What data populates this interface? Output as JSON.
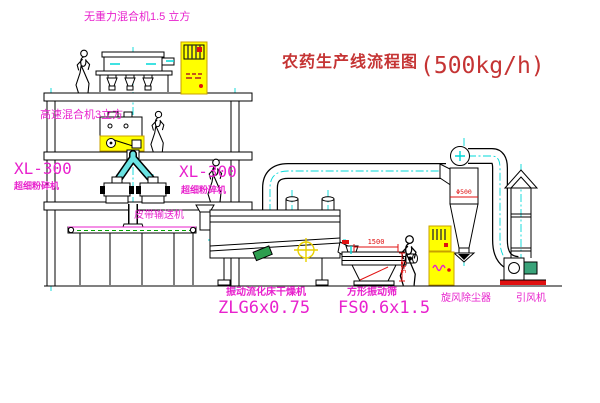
{
  "title": {
    "zh": "农药生产线流程图",
    "capacity": "(500kg/h)"
  },
  "labels": {
    "gravity_mixer": "无重力混合机1.5 立方",
    "high_speed_mixer": "高速混合机3立方",
    "mill_left": {
      "model": "XL-300",
      "name": "超细粉碎机"
    },
    "mill_right": {
      "model": "XL-300",
      "name": "超细粉碎机"
    },
    "belt_conveyor": "皮带输送机",
    "dryer": {
      "name": "振动流化床干燥机",
      "model": "ZLG6x0.75"
    },
    "sieve": {
      "name": "方形振动筛",
      "model": "FS0.6x1.5"
    },
    "cyclone": "旋风除尘器",
    "fan": "引风机"
  },
  "dimensions": {
    "sieve_length": "1500",
    "sieve_height": "545",
    "cyclone_note": "Φ500"
  },
  "colors": {
    "magenta_label": "#e821cd",
    "red_title": "#c53434",
    "dimension_red": "#e01111",
    "centerline_cyan": "#00d8d8",
    "cabinet_yellow": "#ffff00",
    "belt_green": "#00a000",
    "line_black": "#000000"
  }
}
